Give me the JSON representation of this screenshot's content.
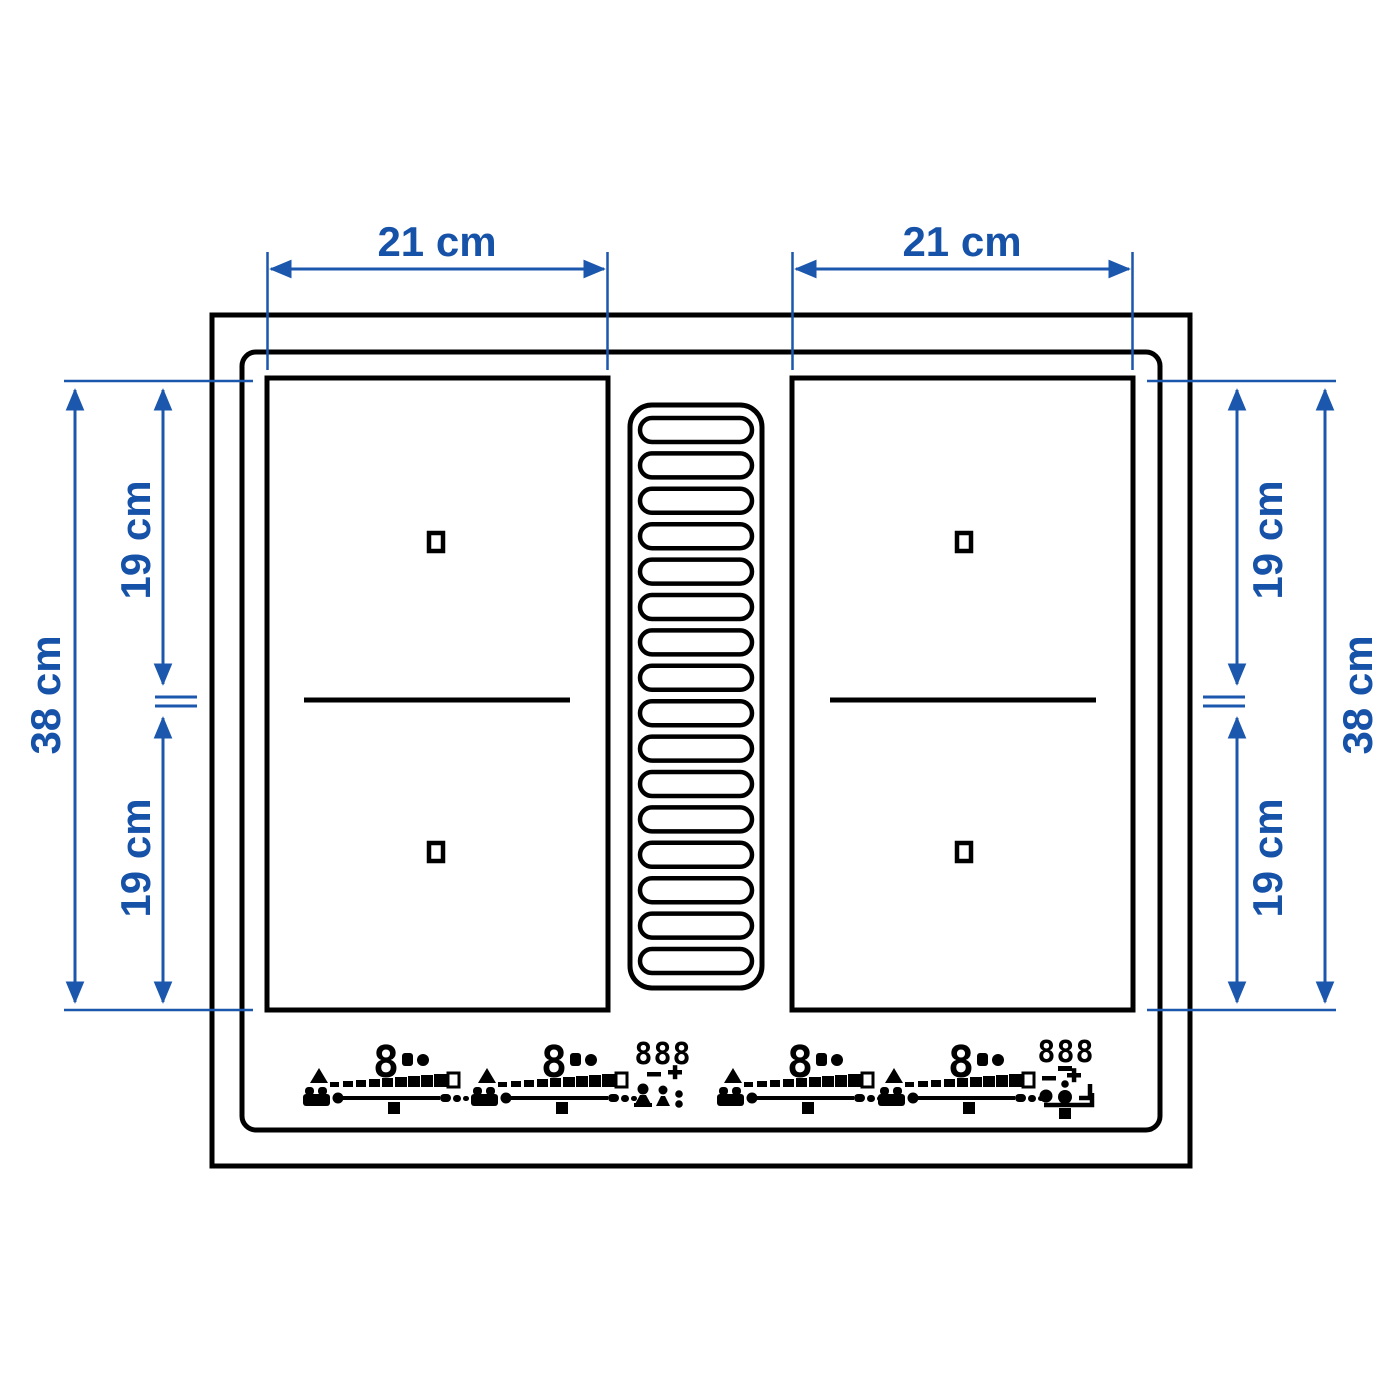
{
  "title": "Induction hob with built-in extractor — dimension diagram",
  "colors": {
    "dimension_text": "#1652a8",
    "dimension_line": "#1b57ad",
    "outline_black": "#000000",
    "background": "#ffffff"
  },
  "dimensions": {
    "left_zone_width": "21 cm",
    "right_zone_width": "21 cm",
    "left_total_depth": "38 cm",
    "right_total_depth": "38 cm",
    "left_upper_zone_depth": "19 cm",
    "left_lower_zone_depth": "19 cm",
    "right_upper_zone_depth": "19 cm",
    "right_lower_zone_depth": "19 cm"
  },
  "controls": {
    "zone_power_display": "8",
    "center_display": "888",
    "fan_display": "888"
  },
  "icons": {
    "vent": "extractor-vent-grille",
    "slider_group": [
      "warning-triangle-icon",
      "power-scale-icon",
      "pot-icon",
      "slider-track-icon",
      "slider-dot-icon",
      "slider-end-dashes-icon",
      "pause-square-icon",
      "lock-icon",
      "timer-dot-icon"
    ],
    "center_display_group": [
      "minus-icon",
      "plus-icon",
      "person-icon",
      "child-lock-icon",
      "colon-icon"
    ],
    "fan_display_group": [
      "minus-icon",
      "plus-icon",
      "fan-circle-icon",
      "fan-dot-circle-icon",
      "corner-bracket-icon",
      "airflow-bracket-icon",
      "pause-square-icon"
    ]
  }
}
